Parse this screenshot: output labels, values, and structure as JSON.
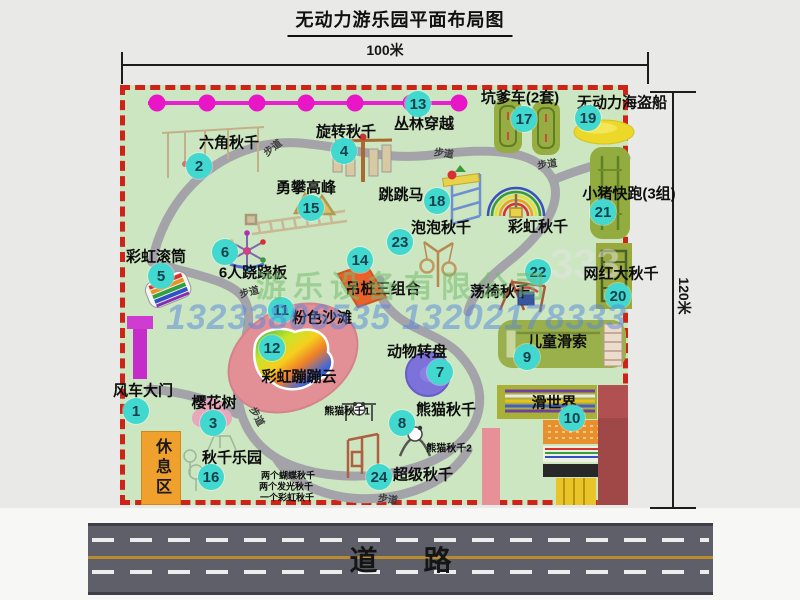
{
  "title": "无动力游乐园平面布局图",
  "dimensions": {
    "horizontal": "100米",
    "vertical": "120米"
  },
  "road": {
    "label": "道路"
  },
  "rest_area": {
    "label": "休息区"
  },
  "watermark": {
    "company": "游乐设备有限公司",
    "phone": "13233806535 13202178333",
    "faint": "333"
  },
  "markers": [
    {
      "n": "1",
      "label": "风车大门",
      "bx": 136,
      "by": 411,
      "lx": 143,
      "ly": 390
    },
    {
      "n": "2",
      "label": "六角秋千",
      "bx": 199,
      "by": 166,
      "lx": 229,
      "ly": 142
    },
    {
      "n": "3",
      "label": "樱花树",
      "bx": 213,
      "by": 423,
      "lx": 214,
      "ly": 402
    },
    {
      "n": "4",
      "label": "旋转秋千",
      "bx": 344,
      "by": 151,
      "lx": 346,
      "ly": 131
    },
    {
      "n": "5",
      "label": "彩虹滚筒",
      "bx": 161,
      "by": 276,
      "lx": 156,
      "ly": 256
    },
    {
      "n": "6",
      "label": "6人跷跷板",
      "bx": 225,
      "by": 252,
      "lx": 253,
      "ly": 272
    },
    {
      "n": "7",
      "label": "动物转盘",
      "bx": 440,
      "by": 372,
      "lx": 417,
      "ly": 351
    },
    {
      "n": "8",
      "label": "熊猫秋千",
      "bx": 402,
      "by": 423,
      "lx": 446,
      "ly": 409
    },
    {
      "n": "9",
      "label": "儿童滑索",
      "bx": 527,
      "by": 357,
      "lx": 557,
      "ly": 341
    },
    {
      "n": "10",
      "label": "滑世界",
      "bx": 572,
      "by": 418,
      "lx": 554,
      "ly": 402
    },
    {
      "n": "11",
      "label": "粉色沙滩",
      "bx": 281,
      "by": 310,
      "lx": 322,
      "ly": 317
    },
    {
      "n": "12",
      "label": "彩虹蹦蹦云",
      "bx": 272,
      "by": 348,
      "lx": 299,
      "ly": 376
    },
    {
      "n": "13",
      "label": "丛林穿越",
      "bx": 418,
      "by": 104,
      "lx": 424,
      "ly": 123
    },
    {
      "n": "14",
      "label": "吊桩三组合",
      "bx": 360,
      "by": 260,
      "lx": 383,
      "ly": 288
    },
    {
      "n": "15",
      "label": "勇攀高峰",
      "bx": 311,
      "by": 208,
      "lx": 306,
      "ly": 187
    },
    {
      "n": "16",
      "label": "秋千乐园",
      "bx": 211,
      "by": 477,
      "lx": 232,
      "ly": 457
    },
    {
      "n": "17",
      "label": "坑爹车(2套)",
      "bx": 524,
      "by": 119,
      "lx": 520,
      "ly": 97
    },
    {
      "n": "18",
      "label": "跳跳马",
      "bx": 437,
      "by": 201,
      "lx": 401,
      "ly": 194
    },
    {
      "n": "19",
      "label": "无动力海盗船",
      "bx": 588,
      "by": 118,
      "lx": 622,
      "ly": 102
    },
    {
      "n": "20",
      "label": "网红大秋千",
      "bx": 618,
      "by": 296,
      "lx": 621,
      "ly": 273
    },
    {
      "n": "21",
      "label": "小猪快跑(3组)",
      "bx": 603,
      "by": 212,
      "lx": 629,
      "ly": 193
    },
    {
      "n": "22",
      "label": "荡椅秋千",
      "bx": 538,
      "by": 272,
      "lx": 500,
      "ly": 291
    },
    {
      "n": "23",
      "label": "泡泡秋千",
      "bx": 400,
      "by": 242,
      "lx": 441,
      "ly": 227
    },
    {
      "n": "24",
      "label": "超级秋千",
      "bx": 379,
      "by": 477,
      "lx": 423,
      "ly": 474
    }
  ],
  "extra_labels": [
    {
      "text": "彩虹秋千",
      "x": 538,
      "y": 226,
      "size": 15
    },
    {
      "text": "熊猫秋千1",
      "x": 347,
      "y": 410,
      "size": 10
    },
    {
      "text": "熊猫秋千2",
      "x": 449,
      "y": 447,
      "size": 10
    },
    {
      "text": "两个蝴蝶秋千",
      "x": 288,
      "y": 475,
      "size": 9
    },
    {
      "text": "两个发光秋千",
      "x": 286,
      "y": 486,
      "size": 9
    },
    {
      "text": "一个彩虹秋千",
      "x": 287,
      "y": 497,
      "size": 9
    }
  ],
  "path_labels": [
    {
      "text": "步道",
      "x": 272,
      "y": 147,
      "rot": -38
    },
    {
      "text": "步道",
      "x": 444,
      "y": 152,
      "rot": 8
    },
    {
      "text": "步道",
      "x": 547,
      "y": 163,
      "rot": -8
    },
    {
      "text": "步道",
      "x": 249,
      "y": 291,
      "rot": -15
    },
    {
      "text": "步道",
      "x": 258,
      "y": 416,
      "rot": 62
    },
    {
      "text": "步道",
      "x": 388,
      "y": 498,
      "rot": 8
    }
  ],
  "icons": [
    "jungle-crossing-line",
    "hexagon-swing-icon",
    "rotating-swing-icon",
    "climb-peak-icon",
    "jump-horse-icon",
    "rainbow-swing-icon",
    "rainbow-roller-icon",
    "seesaw-icon",
    "pink-beach-icon",
    "rainbow-cloud-icon",
    "animal-turntable-icon",
    "hanging-pile-icon",
    "swing-chair-icon",
    "bubble-swing-icon",
    "pit-car-icon",
    "pirate-ship-icon",
    "piggy-run-icon",
    "big-swing-icon",
    "kids-zipline-icon",
    "slide-world-icon",
    "panda-swing-icon",
    "super-swing-icon",
    "cherry-tree-icon",
    "swing-park-icon",
    "windmill-gate-icon"
  ],
  "colors": {
    "map_bg": "#cbe6c0",
    "border": "#ce2417",
    "badge": "#41d9cf",
    "jungle_line": "#ea1fd0",
    "road": "#5f5f69",
    "rest_area": "#f0a02c",
    "gate": "#c832cc",
    "pink_beach": "#e28f96",
    "watermark_green": "#76bc70",
    "watermark_blue": "#5686de"
  }
}
